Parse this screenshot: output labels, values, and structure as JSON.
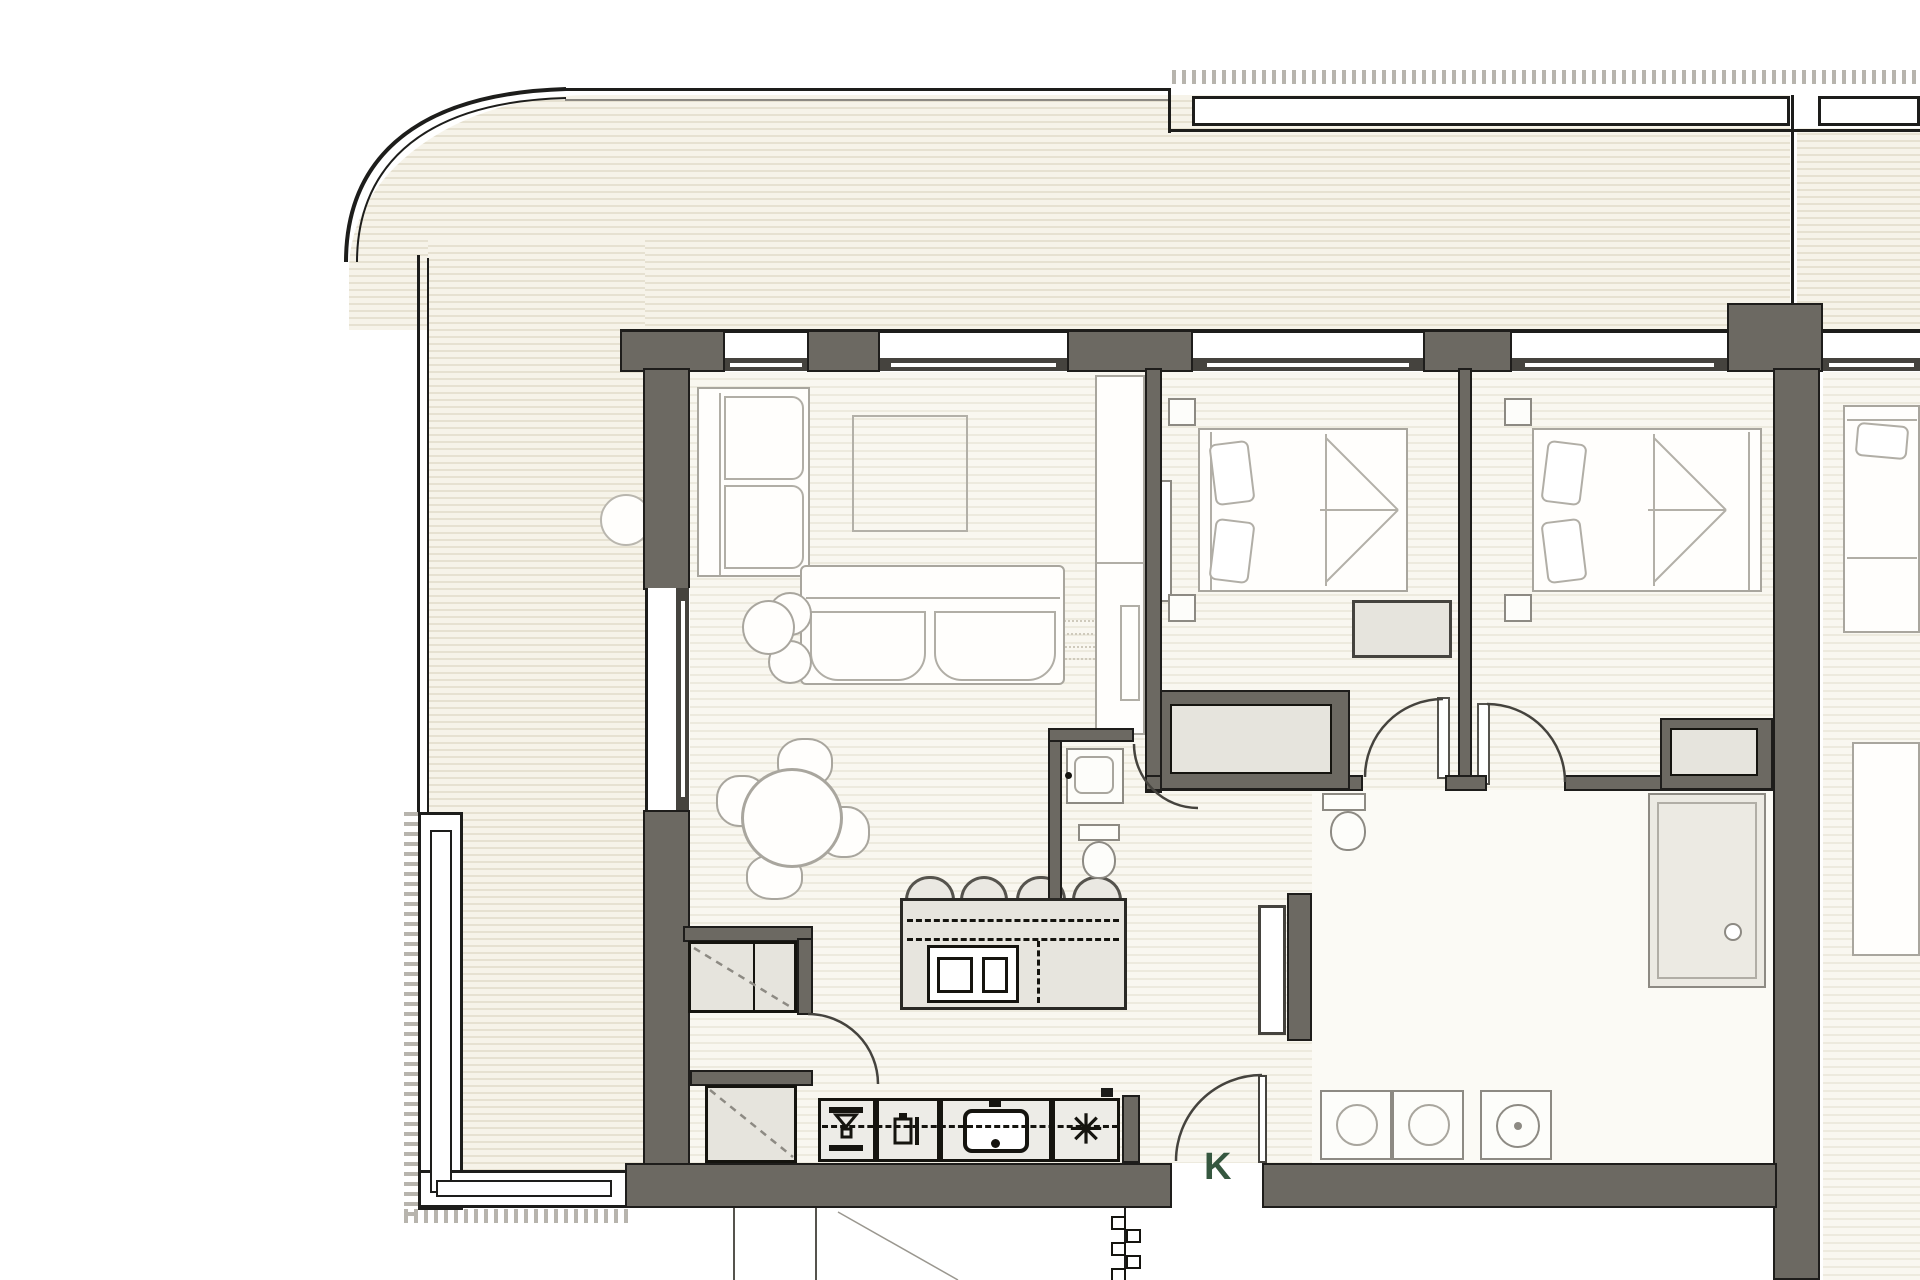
{
  "floor_plan": {
    "entrance_label": "K",
    "icons": {
      "snowflake": "✳"
    },
    "colors": {
      "wall_fill": "#6c6962",
      "wall_outline": "#1e1d1b",
      "balcony_stripe": "#e6e1d1",
      "interior_stripe": "#edeade",
      "furniture_outline": "#a9a69e",
      "appliance_outline": "#15140f",
      "entrance_label_color": "#35573f"
    }
  }
}
